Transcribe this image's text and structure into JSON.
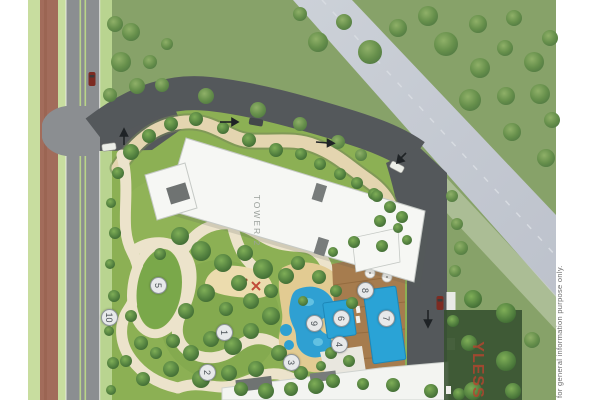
{
  "plan": {
    "tower_label": "TOWER 2",
    "markers": [
      {
        "label": "1"
      },
      {
        "label": "2"
      },
      {
        "label": "3"
      },
      {
        "label": "4"
      },
      {
        "label": "5"
      },
      {
        "label": "6"
      },
      {
        "label": "7"
      },
      {
        "label": "8"
      },
      {
        "label": "9"
      },
      {
        "label": "10"
      }
    ],
    "watermark_partial": "YLESS",
    "disclaimer": "for general information purpose only."
  },
  "icons": {
    "car": "car-icon",
    "direction_arrow": "direction-arrow-icon",
    "umbrella": "umbrella-icon",
    "tree": "tree-icon"
  },
  "colors": {
    "field_green": "#87a269",
    "garden_green": "#8cb054",
    "road_dark": "#54585b",
    "road_light": "#8b8e91",
    "canal_gray": "#c6cbd3",
    "pool_blue": "#2aa3d6",
    "deck_brown": "#a67c4e",
    "path_cream": "#ece3cb",
    "sand_tan": "#e2cb92",
    "brick_red": "#a26c5b",
    "building_white": "#f6f7f4",
    "watermark_red": "#b5452f"
  }
}
